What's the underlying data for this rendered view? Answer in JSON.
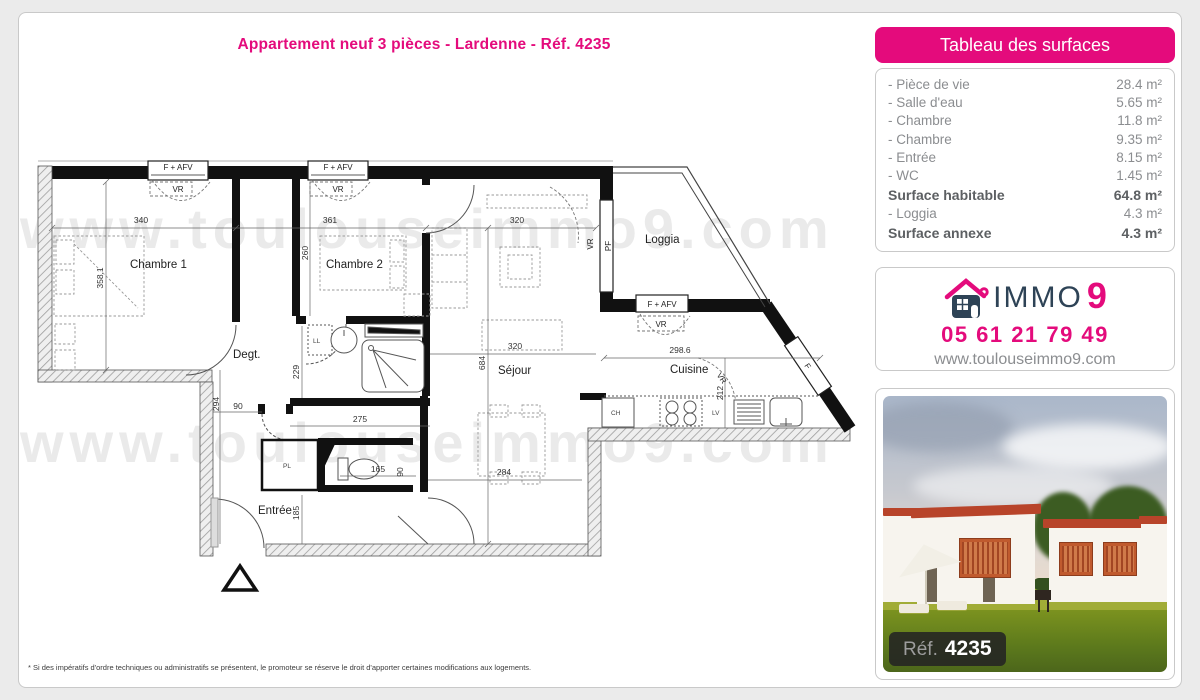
{
  "page": {
    "title": "Appartement neuf 3 pièces - Lardenne - Réf. 4235",
    "footnote": "* Si des impératifs d'ordre techniques ou administratifs se présentent, le promoteur se réserve le droit d'apporter certaines modifications aux logements.",
    "watermark": "www.toulouseimmo9.com"
  },
  "surface_table": {
    "header": "Tableau des surfaces",
    "rows": [
      {
        "label": "- Pièce de vie",
        "value": "28.4 m²",
        "bold": false
      },
      {
        "label": "- Salle d'eau",
        "value": "5.65 m²",
        "bold": false
      },
      {
        "label": "- Chambre",
        "value": "11.8 m²",
        "bold": false
      },
      {
        "label": "- Chambre",
        "value": "9.35 m²",
        "bold": false
      },
      {
        "label": "- Entrée",
        "value": "8.15 m²",
        "bold": false
      },
      {
        "label": "- WC",
        "value": "1.45 m²",
        "bold": false
      },
      {
        "label": "Surface habitable",
        "value": "64.8 m²",
        "bold": true
      },
      {
        "label": "- Loggia",
        "value": "4.3 m²",
        "bold": false
      },
      {
        "label": "Surface annexe",
        "value": "4.3 m²",
        "bold": true
      }
    ]
  },
  "agency": {
    "brand_text": "IMMO",
    "brand_digit": "9",
    "phone": "05 61 21 79 49",
    "website": "www.toulouseimmo9.com"
  },
  "photo": {
    "ref_label": "Réf.",
    "ref_value": "4235"
  },
  "floorplan": {
    "rooms": {
      "chambre1": "Chambre 1",
      "chambre2": "Chambre 2",
      "degagement": "Degt.",
      "sejour": "Séjour",
      "cuisine": "Cuisine",
      "entree": "Entrée",
      "loggia": "Loggia"
    },
    "fixtures": {
      "ll": "LL",
      "pl": "PL",
      "ch": "CH",
      "lv": "LV"
    },
    "windows": {
      "f_afv": "F + AFV",
      "vr": "VR",
      "pf": "PF",
      "f": "F"
    },
    "dims": {
      "w_ch1": "340",
      "w_ch2": "361",
      "w_pdv": "320",
      "h_ch1": "358.1",
      "h_ch2": "260",
      "h_pdv": "684",
      "h_degt": "294",
      "w_door": "90",
      "h_sde": "229",
      "w_sde": "275",
      "h_entree": "185",
      "w_wc": "165",
      "h_wc": "90",
      "w_sejour": "320",
      "w_sejour_low": "284",
      "w_cuisine": "298.6",
      "h_cuisine": "212"
    }
  },
  "colors": {
    "brand_pink": "#e40b7c",
    "brand_navy": "#2e4356",
    "watermark_gray": "#eaeaea"
  }
}
